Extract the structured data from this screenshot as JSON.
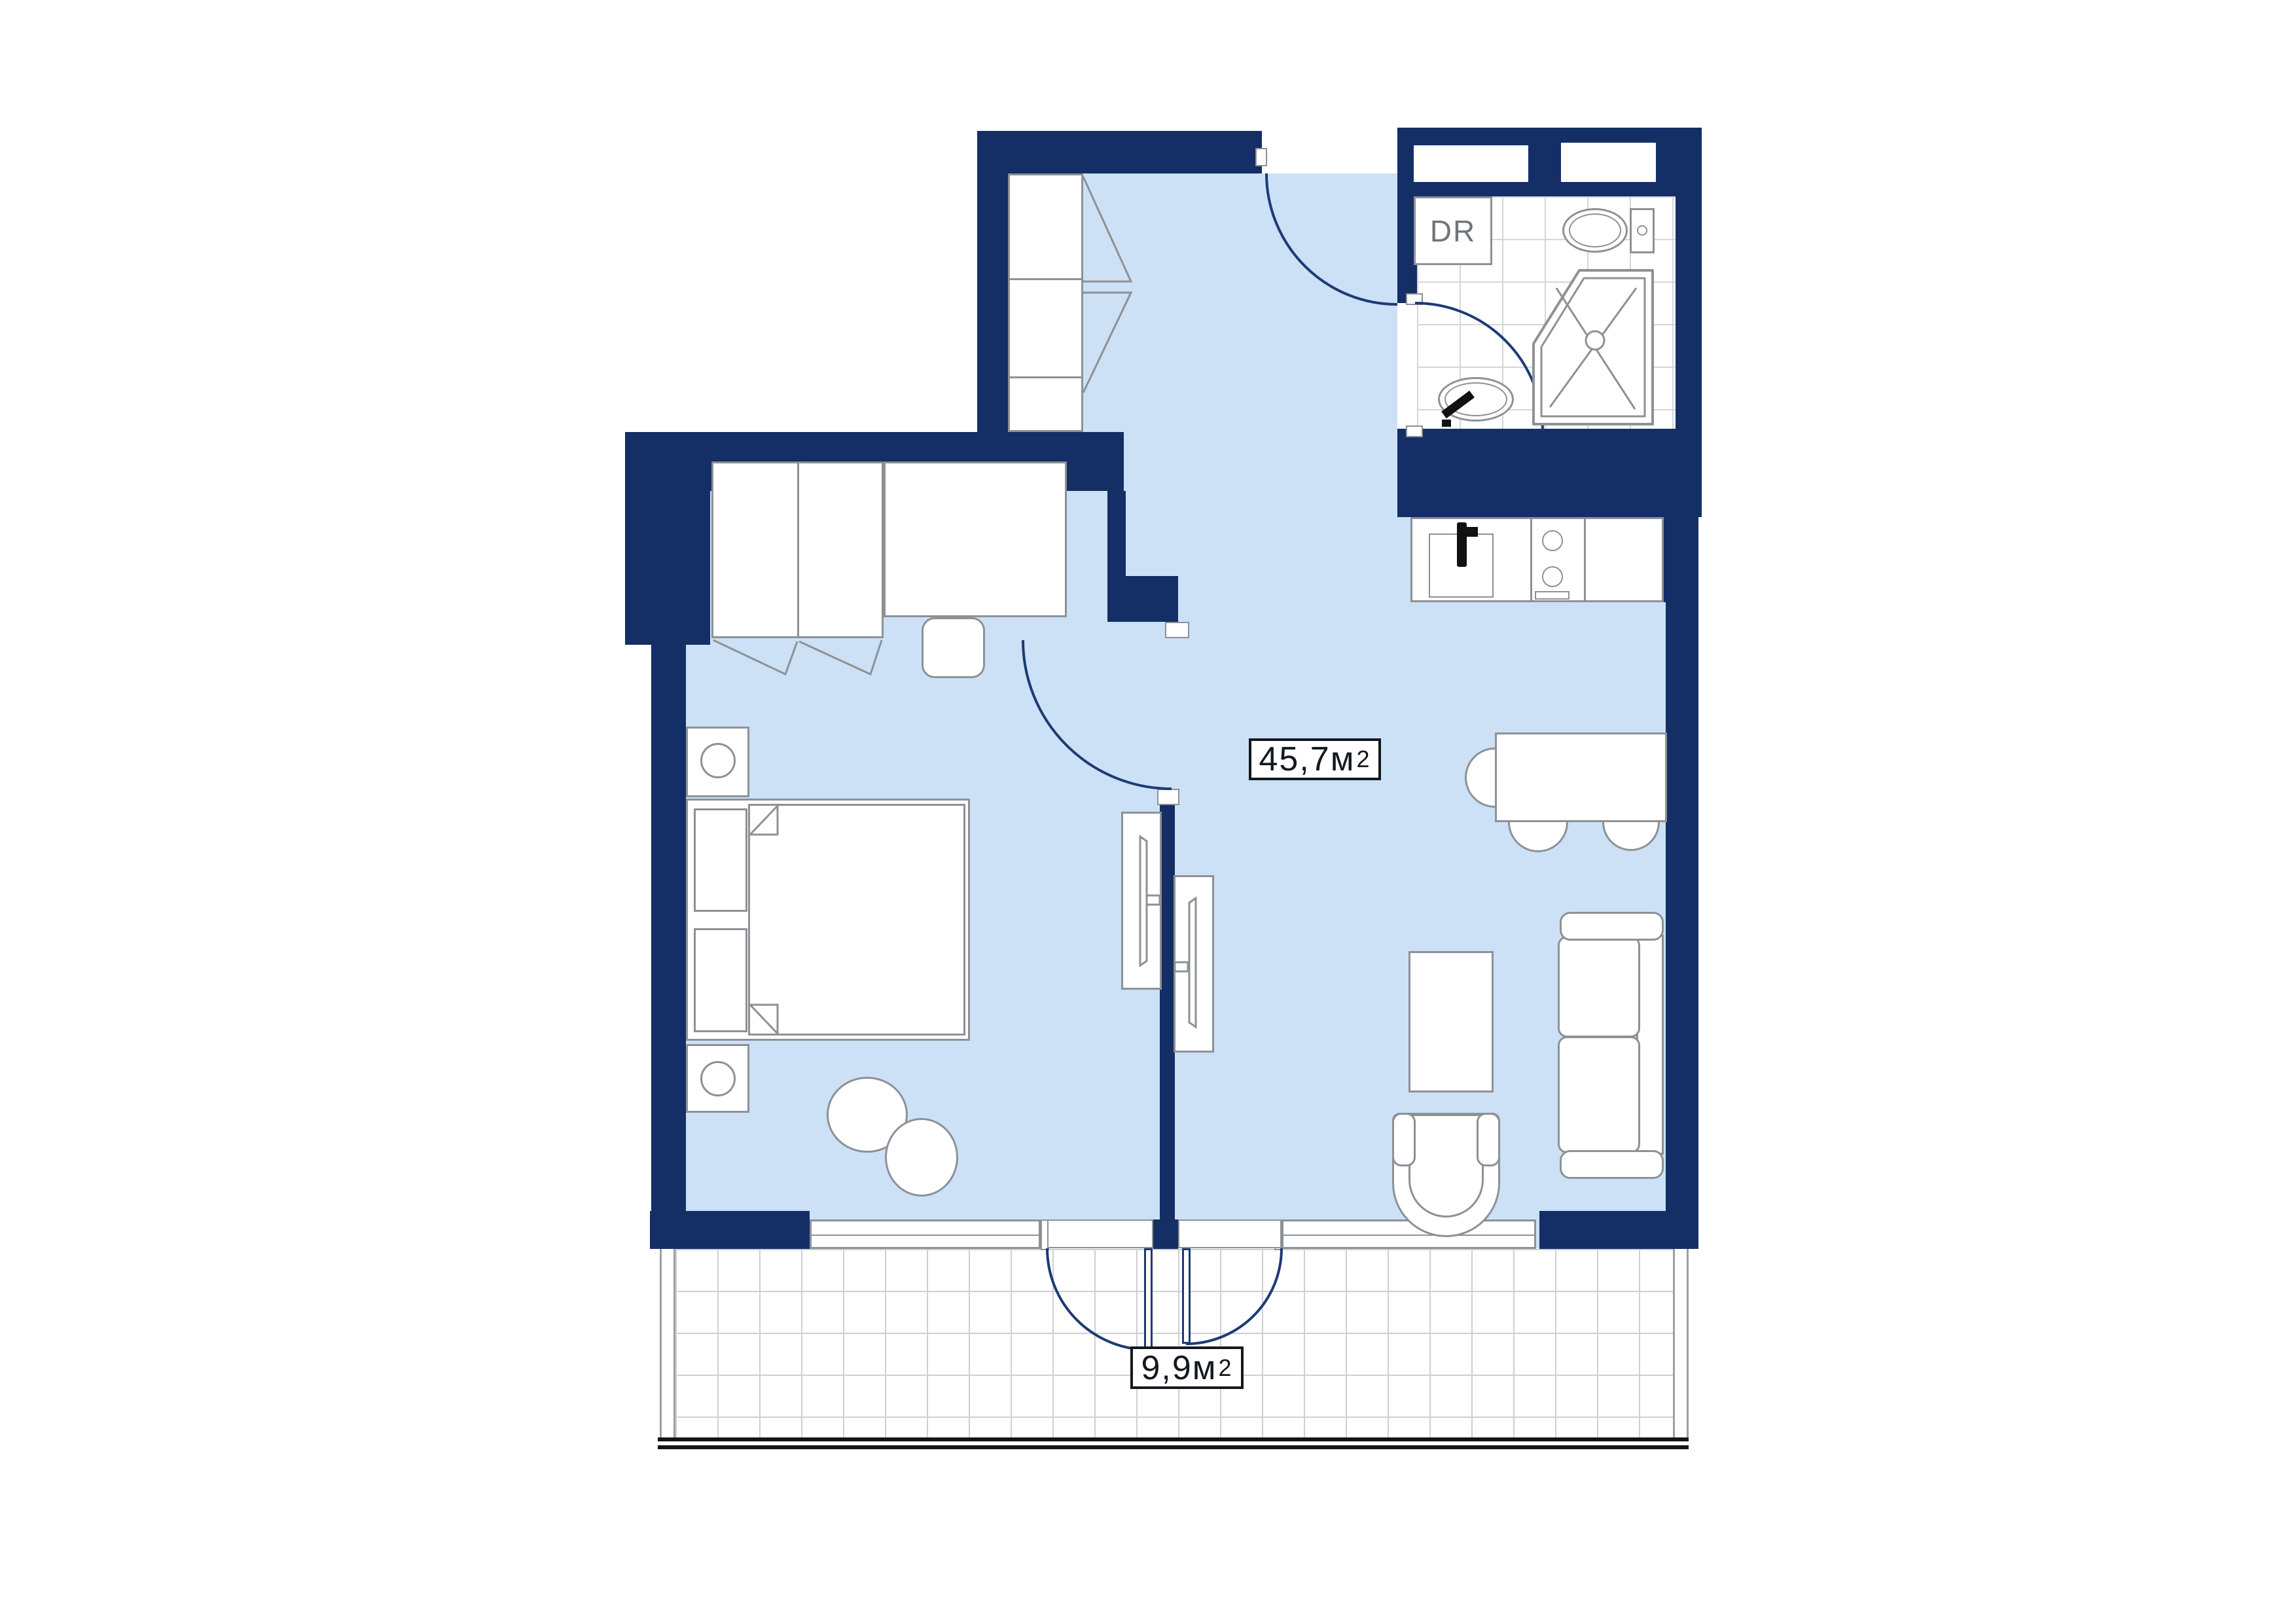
{
  "colors": {
    "wall": "#142e66",
    "floor": "#cce1f6",
    "furniture_line": "#8d9196",
    "tile_line": "#d3d6da",
    "door_arc": "#1d3a73",
    "railing": "#141414",
    "label_text": "#14181f",
    "dr_text": "#70757b"
  },
  "labels": {
    "living_area": {
      "value": "45,7 ",
      "unit": "м",
      "sup": "2"
    },
    "balcony_area": {
      "value": "9,9 ",
      "unit": "м",
      "sup": "2"
    },
    "dryer": "DR"
  }
}
